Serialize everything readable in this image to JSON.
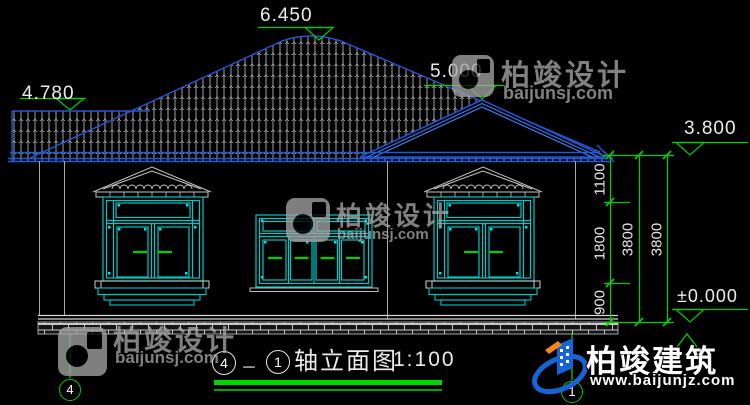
{
  "marks": {
    "ridge": "6.450",
    "wing": "4.780",
    "gable": "5.000",
    "eave": "3.800",
    "ground": "±0.000"
  },
  "dims": {
    "v1": "1100",
    "v2": "1800",
    "v3": "900",
    "t1": "3800",
    "t2": "3800"
  },
  "title": {
    "start": "4",
    "dash": "－",
    "end": "1",
    "name": "轴立面图",
    "scale": "1:100"
  },
  "axes": {
    "left": "4",
    "right": "1"
  },
  "wm": {
    "design_name": "柏竣设计",
    "design_url": "baijunsj.com",
    "build_name": "柏竣建筑",
    "build_url": "www.baijunjz.com"
  },
  "colors": {
    "roof_blue": "#2257d8",
    "frame_cyan": "#00c8c8",
    "dim_green": "#00cf00",
    "tile_gray": "#b0b0b0",
    "text_white": "#ececec"
  }
}
